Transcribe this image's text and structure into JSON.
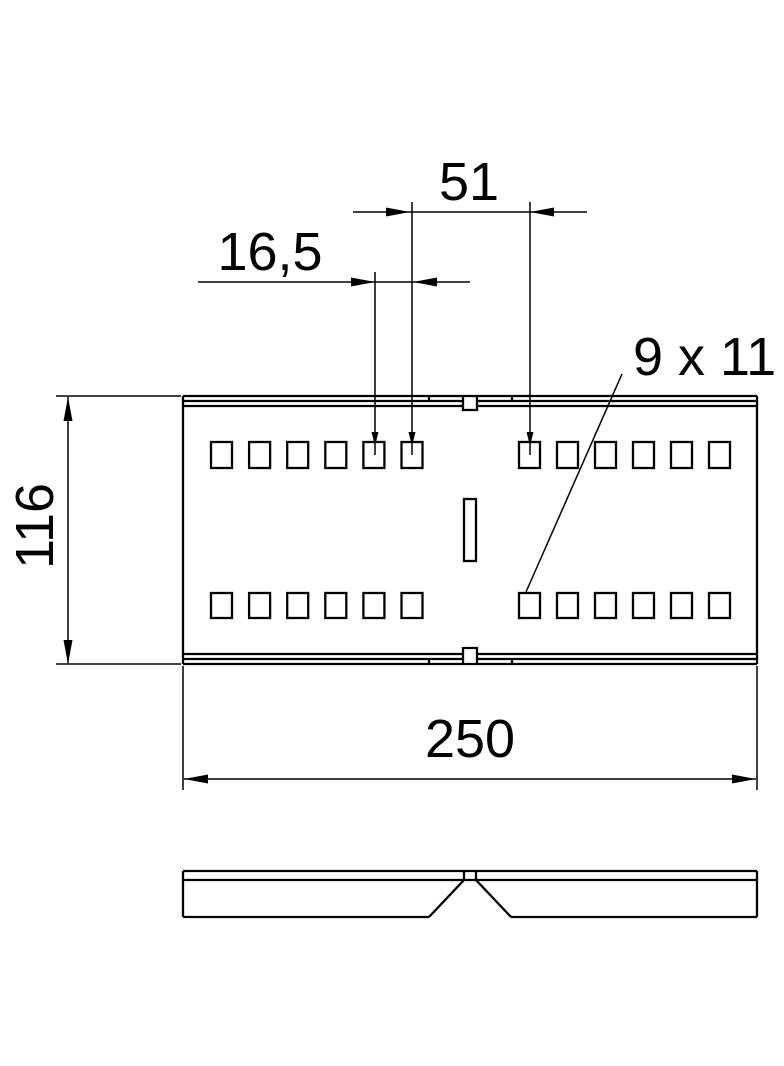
{
  "drawing": {
    "type": "technical-dimension-drawing",
    "background": "#ffffff",
    "line_color": "#000000",
    "labels": {
      "hole_group_distance": "51",
      "hole_pitch": "16,5",
      "hole_size": "9 x 11",
      "plate_width": "116",
      "plate_length": "250"
    },
    "views": {
      "top_view": {
        "hole_rows": 2,
        "hole_groups_per_row": 2,
        "holes_per_group": 6,
        "center_slot": 1,
        "center_notches": 2
      },
      "side_view": {
        "center_v_cut": 1
      }
    }
  }
}
